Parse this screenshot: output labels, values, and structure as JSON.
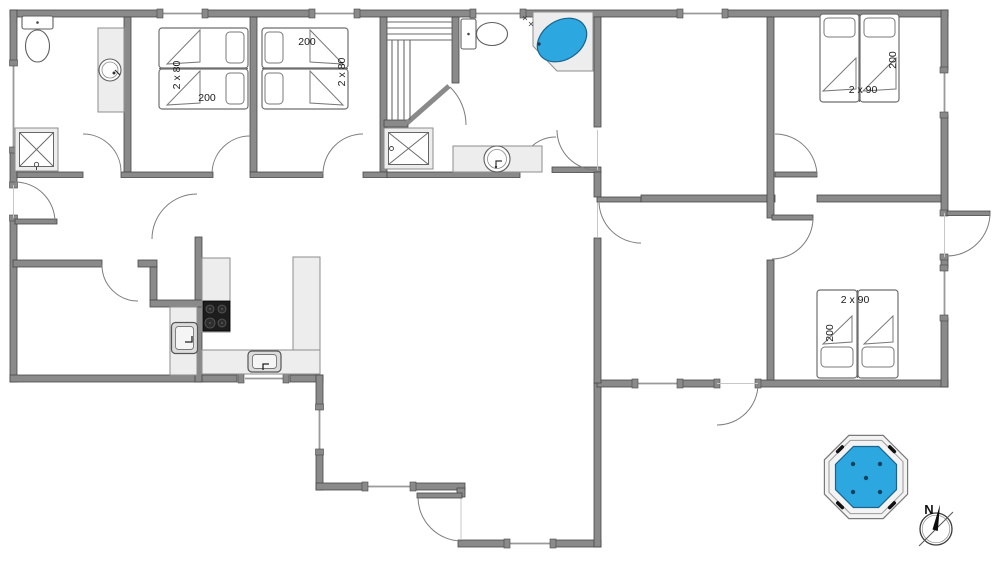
{
  "bedrooms": {
    "top_left": {
      "bed_size": "2 x 80",
      "bed_length": "200"
    },
    "top_middle": {
      "bed_size": "2 x 80",
      "bed_length": "200"
    },
    "top_right": {
      "bed_size": "2 x 90",
      "bed_length": "200"
    },
    "bottom_right": {
      "bed_size": "2 x 90",
      "bed_length": "200"
    }
  },
  "compass": {
    "north": "N"
  },
  "colors": {
    "wall": "#8a8a8a",
    "wall_edge": "#474747",
    "water": "#2da7df",
    "water_edge": "#19648f",
    "counter": "#ededed",
    "stove": "#1d1d1d"
  },
  "fixtures": [
    "toilet-icon",
    "shower-icon",
    "washbasin-icon",
    "sauna-bench-icon",
    "corner-bathtub-icon",
    "stove-icon",
    "kitchen-sink-icon",
    "utility-sink-icon",
    "hot-tub-icon",
    "compass-icon",
    "bed-icon"
  ]
}
